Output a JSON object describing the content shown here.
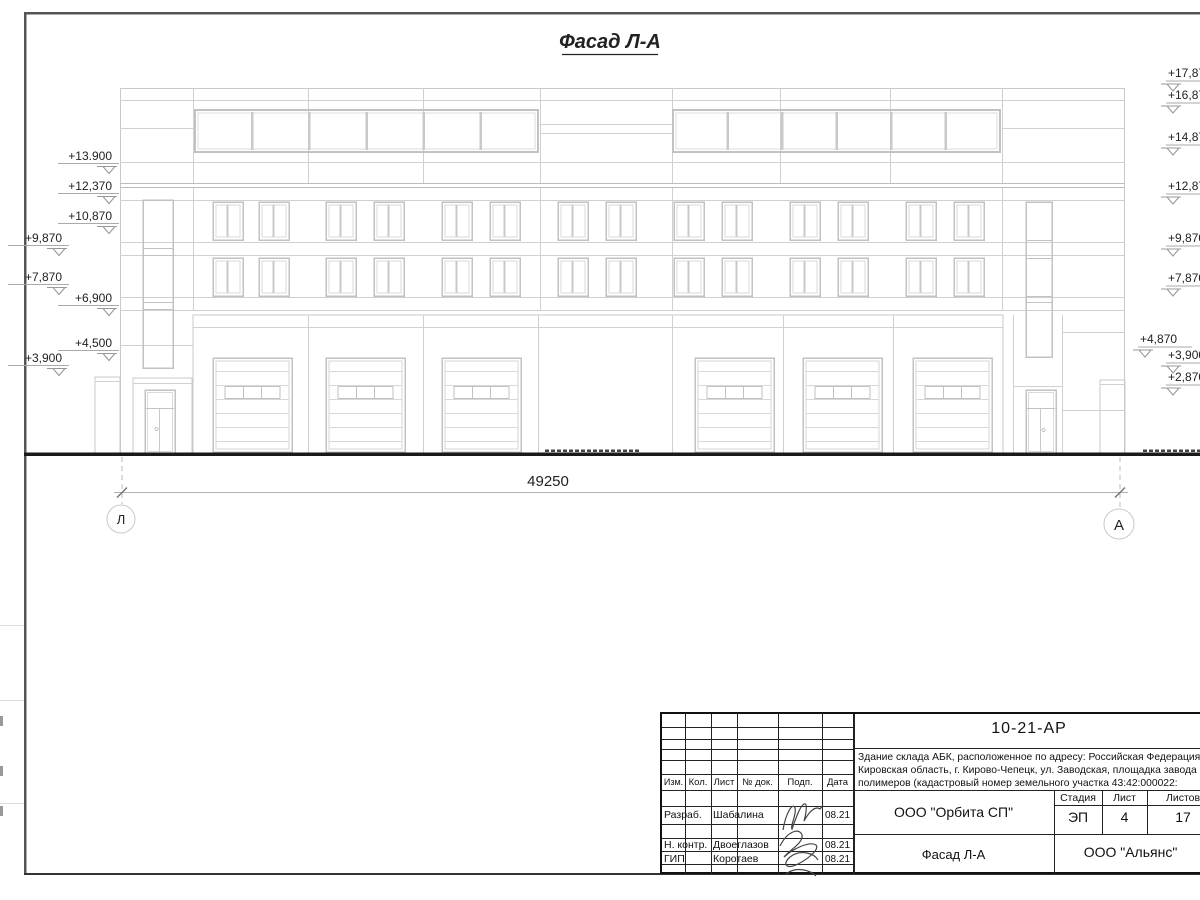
{
  "sheet": {
    "title": "Фасад Л-А",
    "dimension_label": "49250",
    "axis_left": "Л",
    "axis_right": "А",
    "elevations_left": [
      "+13.900",
      "+12,370",
      "+10,870",
      "+9,870",
      "+7,870",
      "+6,900",
      "+4,500",
      "+3,900"
    ],
    "elevations_right": [
      "+17,870",
      "+16,870",
      "+14,870",
      "+12,870",
      "+9,870",
      "+7,870",
      "+4,870",
      "+3,900",
      "+2,870"
    ]
  },
  "title_block": {
    "doc_number": "10-21-АР",
    "description_lines": [
      "Здание склада АБК, расположенное по адресу: Российская Федерация,",
      "Кировская область, г. Кирово-Чепецк, ул. Заводская, площадка завода",
      "полимеров (кадастровый номер земельного участка 43:42:000022:"
    ],
    "revision_columns": [
      "Изм.",
      "Кол.",
      "Лист",
      "№ док.",
      "Подп.",
      "Дата"
    ],
    "stage_columns": [
      "Стадия",
      "Лист",
      "Листов"
    ],
    "stage": "ЭП",
    "sheet_number": "4",
    "sheet_count": "17",
    "design_org": "ООО \"Орбита СП\"",
    "sheet_title": "Фасад Л-А",
    "contractor_org": "ООО \"Альянс\"",
    "roles": [
      {
        "role": "Разраб.",
        "name": "Шабалина",
        "date": "08.21"
      },
      {
        "role": "Н. контр.",
        "name": "Двоеглазов",
        "date": "08.21"
      },
      {
        "role": "ГИП",
        "name": "Коротаев",
        "date": "08.21"
      }
    ]
  }
}
